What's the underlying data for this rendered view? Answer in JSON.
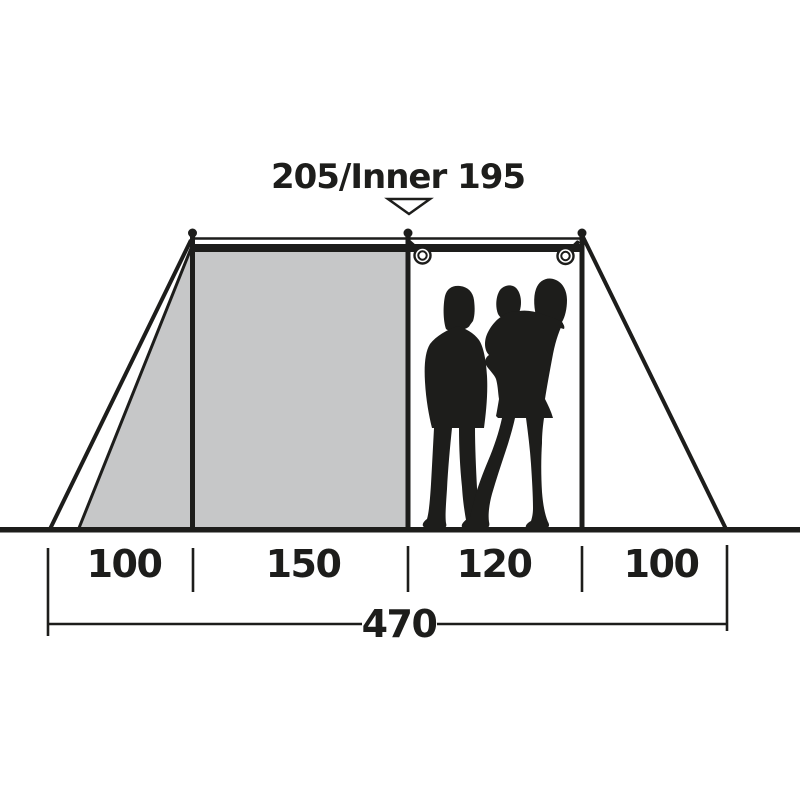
{
  "diagram": {
    "title": "205/Inner 195",
    "sections": [
      "100",
      "150",
      "120",
      "100"
    ],
    "total": "470",
    "colors": {
      "line": "#1d1d1b",
      "inner_tent_fill": "#c6c7c8",
      "background": "#ffffff"
    }
  }
}
